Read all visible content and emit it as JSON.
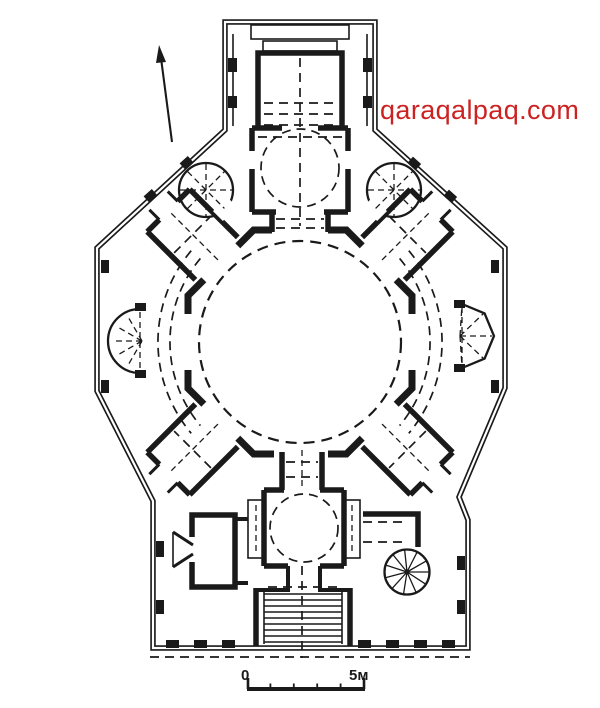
{
  "colors": {
    "ink": "#1a1a1a",
    "paper": "#ffffff",
    "watermark_red": "#cc2222"
  },
  "drawing": {
    "type": "architectural-floor-plan",
    "subject": "domed building plan with central round hall, entrance portal, corner fan rooms, side niches, stairs and spiral staircase"
  },
  "watermark": {
    "text": "qaraqalpaq.com"
  },
  "scale_bar": {
    "start_label": "0",
    "end_label": "5м"
  },
  "icons": {
    "compass": "north-arrow",
    "stairs": "staircase",
    "spiral": "spiral-staircase"
  }
}
